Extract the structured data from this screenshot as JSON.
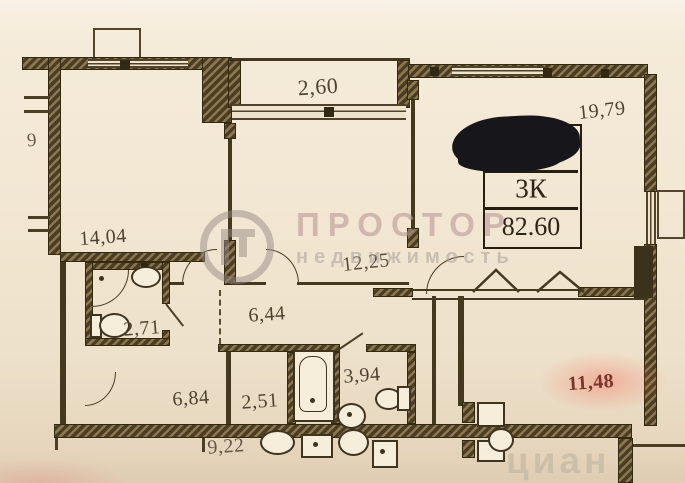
{
  "rooms": {
    "balcony_top": "2,60",
    "living_top_right": "19,79",
    "room_top_left": "14,04",
    "room_middle": "12,25",
    "bathroom": "2,71",
    "hallway": "6,44",
    "hallway_lower": "6,84",
    "bath_small": "2,51",
    "wc": "3,94",
    "room_bottom_right": "11,48",
    "neighbor_below": "9,22",
    "left_edge_fragment": "9"
  },
  "stamp": {
    "rooms_label": "3К",
    "total_area": "82.60"
  },
  "watermark": {
    "brand": "ПРОСТОР",
    "subtitle": "недвижимость",
    "corner_brand": "циан"
  },
  "colors": {
    "paper": "#f2e7d3",
    "wall": "#44381f",
    "area_label": "#4f4332",
    "highlight_label": "#7a362b",
    "highlight_glow": "#fa6e5a",
    "redaction": "#17171b",
    "watermark_brand": "#ba9896",
    "watermark_gray": "#a8a098"
  }
}
